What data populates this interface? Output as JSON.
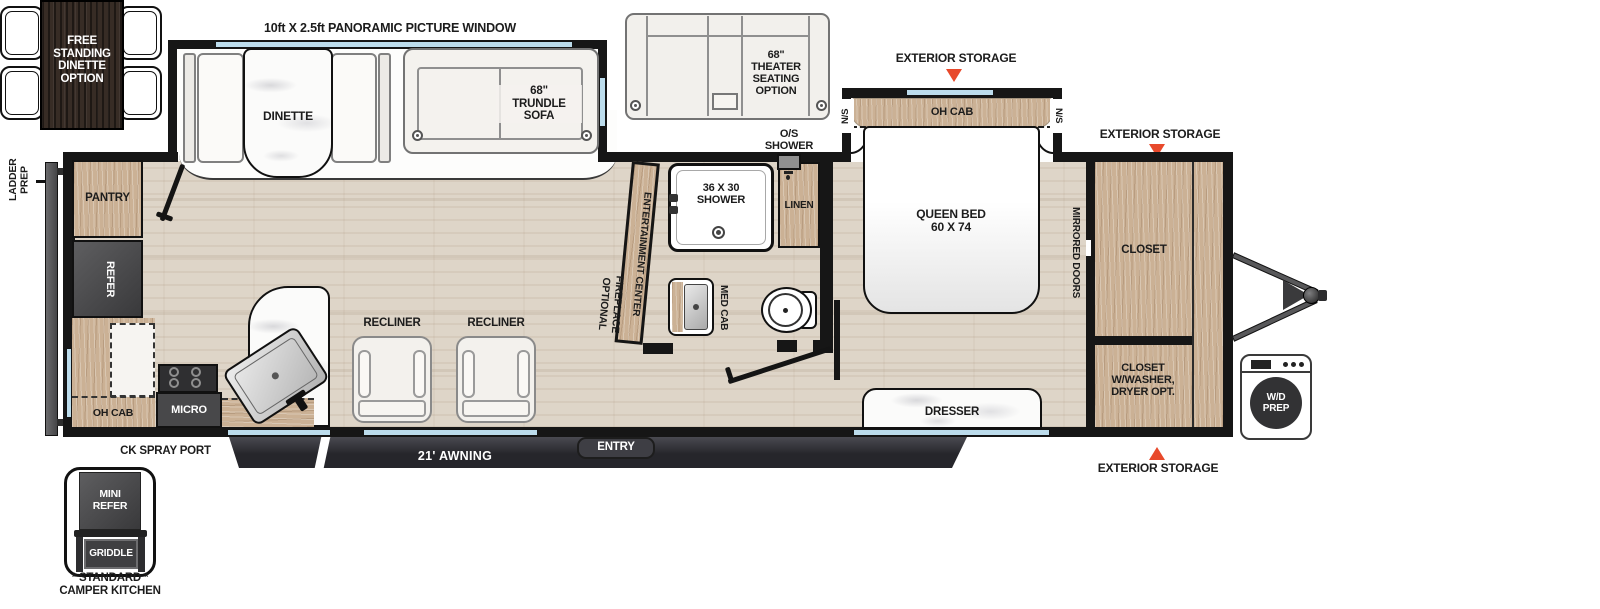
{
  "title": "Travel Trailer Floor Plan",
  "labels": {
    "panoramic_window": "10ft X 2.5ft PANORAMIC PICTURE WINDOW",
    "free_standing_dinette": "FREE\nSTANDING\nDINETTE\nOPTION",
    "dinette": "DINETTE",
    "trundle_sofa": "68\"\nTRUNDLE\nSOFA",
    "theater_seating": "68\"\nTHEATER\nSEATING\nOPTION",
    "exterior_storage": "EXTERIOR STORAGE",
    "oh_cab": "OH CAB",
    "ns": "N/S",
    "queen_bed": "QUEEN BED\n60 X 74",
    "mirrored_doors": "MIRRORED DOORS",
    "closet": "CLOSET",
    "closet_washer": "CLOSET\nW/WASHER,\nDRYER OPT.",
    "wd_prep": "W/D\nPREP",
    "os_shower": "O/S\nSHOWER",
    "shower_36x30": "36 X 30\nSHOWER",
    "linen": "LINEN",
    "entertainment_center": "ENTERTAINMENT CENTER",
    "optional_fireplace": "OPTIONAL\nFIREPLACE",
    "med_cab": "MED CAB",
    "pantry": "PANTRY",
    "refer": "REFER",
    "micro": "MICRO",
    "recliner": "RECLINER",
    "dresser": "DRESSER",
    "entry": "ENTRY",
    "awning": "21' AWNING",
    "ck_spray_port": "CK SPRAY PORT",
    "ladder_prep": "LADDER\nPREP",
    "mini_refer": "MINI\nREFER",
    "griddle": "GRIDDLE",
    "camper_kitchen": "* STANDARD *\nCAMPER KITCHEN"
  },
  "colors": {
    "accent_red": "#e8492b",
    "window_blue": "#bcdcec",
    "wall_black": "#161616",
    "cabinet_wood": "#cbb195",
    "dark_wood": "#372c25",
    "floor": "#ded5c8",
    "appliance_dark": "#48484a",
    "awning_dark": "#2c2c31"
  }
}
